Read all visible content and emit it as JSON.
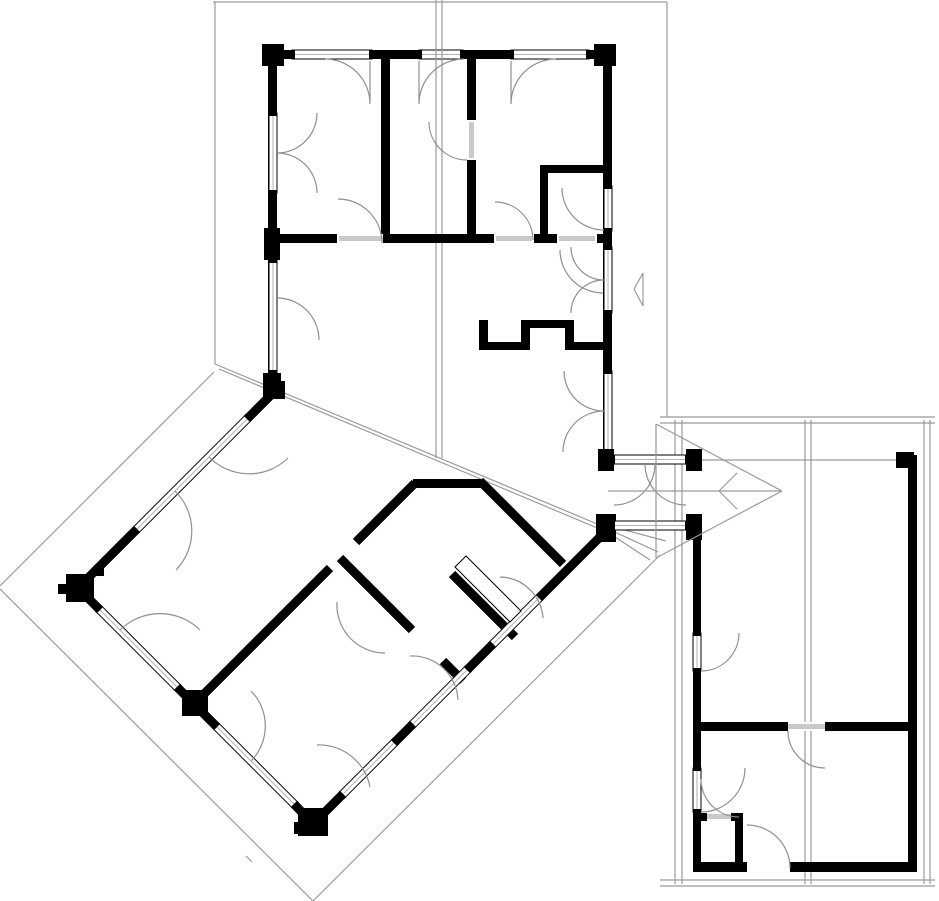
{
  "plan": {
    "canvas": {
      "width": 939,
      "height": 901,
      "background": "#ffffff"
    },
    "colors": {
      "wall": "#000000",
      "thin_line": "#9a9a9a",
      "arc_line": "#8f8f8f",
      "door_leaf": "#c9c9c9",
      "window_center": "#b0b0b0",
      "window_fill": "#ffffff"
    },
    "roof_lines": [
      [
        213,
        2,
        667,
        2
      ],
      [
        215,
        2,
        215,
        364
      ],
      [
        667,
        2,
        667,
        417
      ],
      [
        436,
        0,
        436,
        458
      ],
      [
        442,
        0,
        442,
        458
      ],
      [
        215,
        364,
        602,
        526
      ],
      [
        219,
        369,
        602,
        530
      ],
      [
        214,
        372,
        0,
        586
      ],
      [
        0,
        589,
        313,
        901
      ],
      [
        313,
        901,
        660,
        555
      ],
      [
        675,
        420,
        675,
        884
      ],
      [
        682,
        420,
        682,
        884
      ],
      [
        805,
        420,
        805,
        884
      ],
      [
        811,
        420,
        811,
        884
      ],
      [
        924,
        420,
        924,
        884
      ],
      [
        930,
        420,
        930,
        884
      ],
      [
        660,
        417,
        935,
        417
      ],
      [
        660,
        423,
        935,
        423
      ],
      [
        660,
        880,
        935,
        880
      ],
      [
        660,
        886,
        935,
        886
      ],
      [
        702,
        460,
        898,
        460
      ],
      [
        606,
        528,
        658,
        552
      ],
      [
        606,
        531,
        650,
        560
      ],
      [
        606,
        525,
        666,
        541
      ],
      [
        246,
        856,
        252,
        862
      ]
    ],
    "arrow_lines": [
      [
        656,
        424,
        782,
        491
      ],
      [
        782,
        491,
        656,
        558
      ],
      [
        656,
        424,
        656,
        558
      ],
      [
        608,
        491,
        782,
        491
      ],
      [
        737,
        473,
        719,
        491
      ],
      [
        719,
        491,
        737,
        509
      ],
      [
        643,
        273,
        634,
        289
      ],
      [
        634,
        289,
        643,
        306
      ],
      [
        643,
        273,
        643,
        306
      ]
    ],
    "walls": [
      [
        268,
        50,
        344,
        9
      ],
      [
        268,
        50,
        9,
        345
      ],
      [
        603,
        50,
        9,
        410
      ],
      [
        268,
        234,
        344,
        9
      ],
      [
        381,
        59,
        9,
        175
      ],
      [
        467,
        59,
        9,
        175
      ],
      [
        540,
        165,
        72,
        8
      ],
      [
        540,
        165,
        8,
        78
      ],
      [
        479,
        320,
        9,
        30
      ],
      [
        488,
        342,
        42,
        8
      ],
      [
        521,
        320,
        9,
        22
      ],
      [
        530,
        320,
        44,
        8
      ],
      [
        565,
        328,
        9,
        22
      ],
      [
        574,
        342,
        30,
        8
      ],
      [
        413,
        479,
        71,
        9
      ],
      [
        700,
        722,
        88,
        9
      ],
      [
        825,
        722,
        83,
        9
      ],
      [
        693,
        540,
        8,
        95
      ],
      [
        693,
        671,
        8,
        97
      ],
      [
        693,
        812,
        8,
        60
      ],
      [
        908,
        455,
        9,
        417
      ],
      [
        735,
        813,
        8,
        55
      ],
      [
        697,
        813,
        10,
        8
      ],
      [
        731,
        813,
        12,
        8
      ],
      [
        693,
        862,
        54,
        10
      ],
      [
        790,
        862,
        127,
        10
      ]
    ],
    "wall_lines": [
      [
        275,
        391,
        248,
        418
      ],
      [
        136,
        530,
        78,
        588
      ],
      [
        78,
        588,
        99,
        609
      ],
      [
        176,
        686,
        216,
        726
      ],
      [
        295,
        805,
        313,
        824
      ],
      [
        313,
        824,
        342,
        795
      ],
      [
        395,
        742,
        412,
        725
      ],
      [
        468,
        669,
        492,
        645
      ],
      [
        540,
        597,
        604,
        533
      ],
      [
        480,
        481,
        563,
        564
      ],
      [
        194,
        704,
        330,
        568
      ],
      [
        356,
        542,
        415,
        483
      ],
      [
        340,
        558,
        412,
        630
      ],
      [
        443,
        661,
        463,
        681
      ],
      [
        452,
        574,
        515,
        637
      ]
    ],
    "posts": [
      [
        262,
        44,
        22,
        22
      ],
      [
        594,
        44,
        22,
        22
      ],
      [
        264,
        228,
        16,
        32
      ],
      [
        263,
        373,
        18,
        24
      ],
      [
        265,
        381,
        20,
        18
      ],
      [
        66,
        574,
        28,
        28
      ],
      [
        58,
        584,
        12,
        10
      ],
      [
        94,
        566,
        10,
        10
      ],
      [
        298,
        808,
        30,
        28
      ],
      [
        294,
        822,
        10,
        12
      ],
      [
        182,
        690,
        26,
        26
      ],
      [
        596,
        514,
        20,
        28
      ],
      [
        598,
        449,
        16,
        22
      ],
      [
        686,
        449,
        16,
        22
      ],
      [
        686,
        514,
        16,
        26
      ],
      [
        896,
        452,
        18,
        16
      ]
    ],
    "windows": [
      [
        292,
        50,
        80,
        9
      ],
      [
        419,
        50,
        44,
        9
      ],
      [
        511,
        50,
        78,
        9
      ],
      [
        269,
        113,
        8,
        80
      ],
      [
        269,
        260,
        8,
        113
      ],
      [
        604,
        186,
        8,
        45
      ],
      [
        604,
        247,
        8,
        66
      ],
      [
        604,
        371,
        8,
        81
      ],
      [
        612,
        455,
        76,
        9
      ],
      [
        612,
        521,
        76,
        9
      ],
      [
        693,
        633,
        8,
        38
      ],
      [
        693,
        768,
        8,
        44
      ]
    ],
    "window_lines": [
      [
        248,
        418,
        136,
        530
      ],
      [
        99,
        609,
        178,
        688
      ],
      [
        216,
        726,
        295,
        805
      ],
      [
        342,
        795,
        395,
        742
      ],
      [
        412,
        725,
        468,
        669
      ],
      [
        492,
        645,
        540,
        597
      ]
    ],
    "gaps": [
      [
        337,
        234,
        46,
        9
      ],
      [
        494,
        234,
        40,
        9
      ],
      [
        557,
        234,
        40,
        9
      ],
      [
        467,
        120,
        9,
        40
      ],
      [
        788,
        722,
        37,
        9
      ],
      [
        707,
        813,
        24,
        8
      ],
      [
        747,
        862,
        43,
        10
      ]
    ],
    "leaves": [
      [
        339,
        236,
        44,
        5
      ],
      [
        496,
        236,
        36,
        5
      ],
      [
        559,
        236,
        36,
        5
      ],
      [
        469,
        122,
        5,
        36
      ],
      [
        788,
        724,
        37,
        5
      ],
      [
        707,
        814,
        24,
        5
      ]
    ],
    "open_leaf_polygon": [
      [
        455,
        567
      ],
      [
        466,
        556
      ],
      [
        521,
        611
      ],
      [
        510,
        622
      ]
    ],
    "arcs": [
      "M 325 59 A 45 45 0 0 1 370 104",
      "M 464 59 A 45 45 0 0 0 419 104",
      "M 556 59 A 45 45 0 0 0 511 104",
      "M 277 153 A 40 40 0 0 0 317 113",
      "M 277 153 A 40 40 0 0 1 317 193",
      "M 277 298 A 42 42 0 0 1 319 340",
      "M 382 243 A 44 44 0 0 0 338 199",
      "M 533 240 A 38 38 0 0 0 495 202",
      "M 560 250 A 43 43 0 0 0 603 293",
      "M 467 160 A 38 38 0 0 1 429 122",
      "M 604 230 A 42 42 0 0 1 562 188",
      "M 604 411 A 40 40 0 0 1 564 371",
      "M 604 411 A 41 41 0 0 0 563 452",
      "M 604 280 A 33 33 0 0 1 571 247",
      "M 604 280 A 33 33 0 0 0 571 313",
      "M 655 464 A 41 41 0 0 1 614 505",
      "M 645 464 A 41 41 0 0 0 686 505",
      "M 209 457 A 56 56 0 0 0 288 458",
      "M 175 491 A 56 56 0 0 1 176 570",
      "M 120 630 A 57 57 0 0 1 200 630",
      "M 251 761 A 50 50 0 0 0 251 691",
      "M 317 745 A 52 52 0 0 1 370 787",
      "M 410 656 A 46 46 0 0 1 458 700",
      "M 500 577 A 44 44 0 0 1 543 618",
      "M 337 602 A 48 48 0 0 0 385 653",
      "M 701 671 A 38 38 0 0 0 739 633",
      "M 788 731 A 37 37 0 0 0 825 768",
      "M 701 812 A 44 44 0 0 0 745 768",
      "M 739 817 A 38 38 0 0 1 701 779",
      "M 790 868 A 43 43 0 0 0 747 825"
    ],
    "leaf_lines": [
      [
        370,
        61,
        370,
        102
      ],
      [
        419,
        61,
        419,
        102
      ],
      [
        511,
        61,
        511,
        102
      ]
    ],
    "ridge_overlay": [
      [
        436,
        48,
        436,
        62
      ],
      [
        442,
        48,
        442,
        62
      ]
    ]
  }
}
